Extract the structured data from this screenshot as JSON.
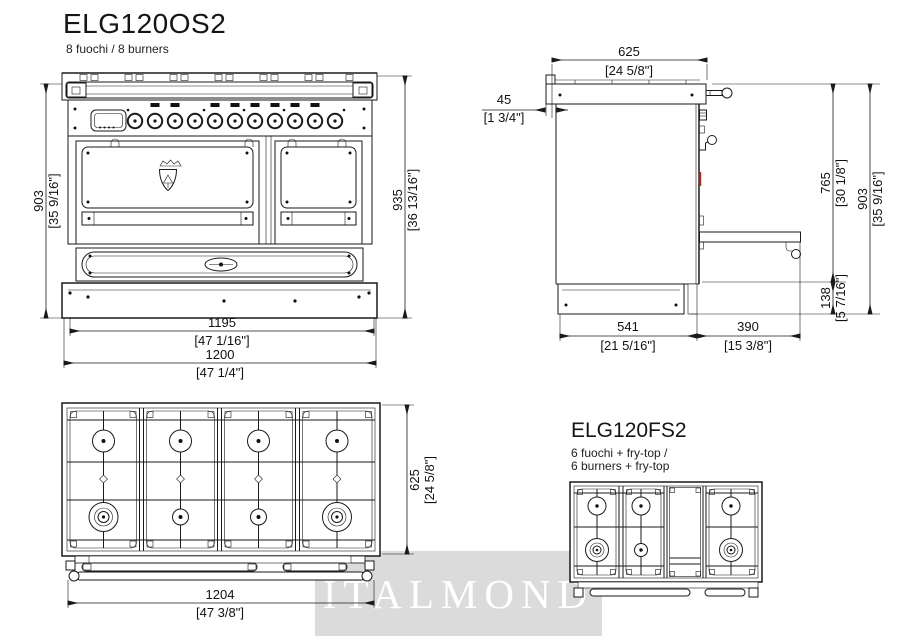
{
  "page": {
    "bg": "#ffffff",
    "line_color": "#1a1a1a",
    "accent_red": "#9e2b1e",
    "watermark_bg": "#dbdbdb"
  },
  "header": {
    "title": "ELG120OS2",
    "subtitle": "8 fuochi / 8 burners"
  },
  "front_view": {
    "dims": {
      "height_deck": {
        "mm": "903",
        "inch": "[35 9/16\"]"
      },
      "height_total": {
        "mm": "935",
        "inch": "[36 13/16\"]"
      },
      "width_body": {
        "mm": "1195",
        "inch": "[47 1/16\"]"
      },
      "width_total": {
        "mm": "1200",
        "inch": "[47 1/4\"]"
      }
    }
  },
  "side_view": {
    "dims": {
      "depth_top": {
        "mm": "625",
        "inch": "[24 5/8\"]"
      },
      "back_offset": {
        "mm": "45",
        "inch": "[1 3/4\"]"
      },
      "height_to_plinth": {
        "mm": "765",
        "inch": "[30 1/8\"]"
      },
      "height_total": {
        "mm": "903",
        "inch": "[35 9/16\"]"
      },
      "plinth_height": {
        "mm": "138",
        "inch": "[5 7/16\"]"
      },
      "depth_body": {
        "mm": "541",
        "inch": "[21 5/16\"]"
      },
      "depth_front": {
        "mm": "390",
        "inch": "[15 3/8\"]"
      }
    }
  },
  "top_view": {
    "dims": {
      "depth": {
        "mm": "625",
        "inch": "[24 5/8\"]"
      },
      "width": {
        "mm": "1204",
        "inch": "[47 3/8\"]"
      }
    }
  },
  "variant": {
    "title": "ELG120FS2",
    "subtitle_line1": "6 fuochi + fry-top /",
    "subtitle_line2": "6 burners + fry-top"
  },
  "watermark": {
    "text": "ITALMOND"
  }
}
